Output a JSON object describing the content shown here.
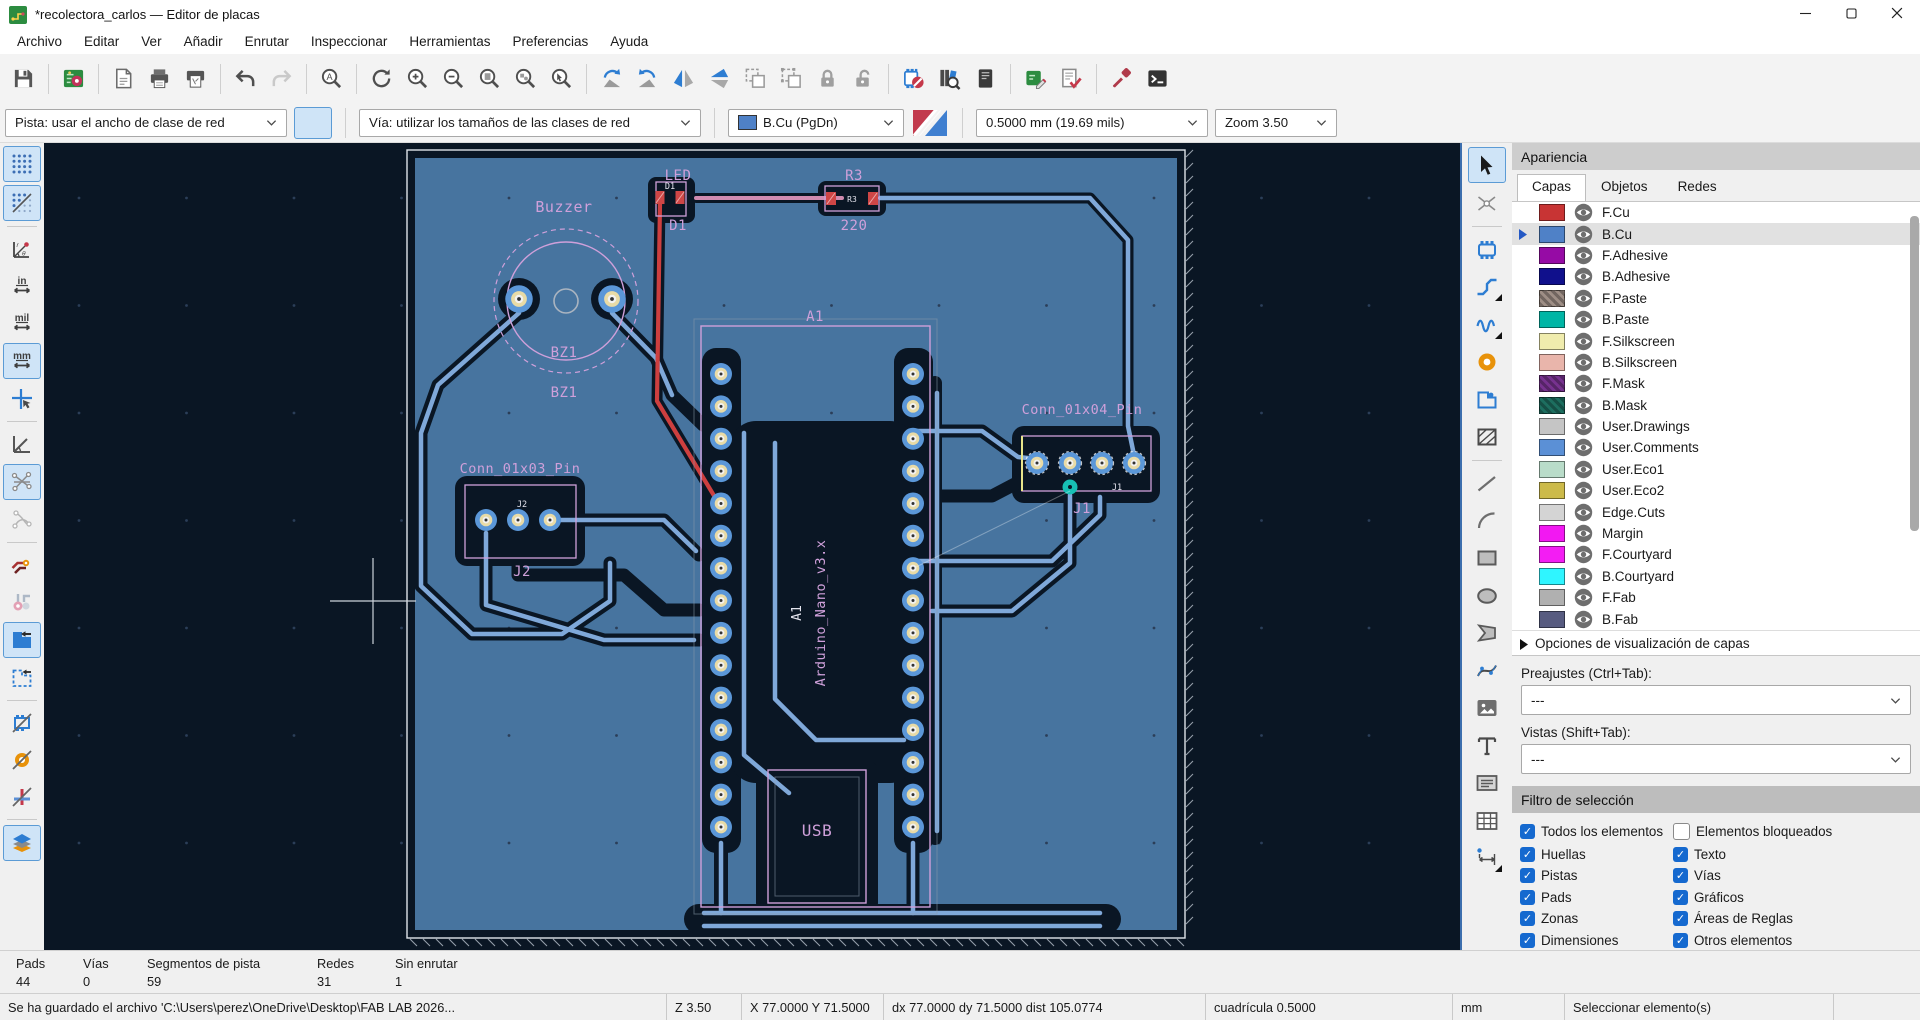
{
  "window": {
    "title": "*recolectora_carlos — Editor de placas"
  },
  "menu": {
    "items": [
      "Archivo",
      "Editar",
      "Ver",
      "Añadir",
      "Enrutar",
      "Inspeccionar",
      "Herramientas",
      "Preferencias",
      "Ayuda"
    ]
  },
  "toolbar": {
    "track_dropdown": "Pista: usar el ancho de clase de red",
    "via_dropdown": "Vía: utilizar los tamaños de las clases de red",
    "layer_dropdown": "B.Cu (PgDn)",
    "layer_color": "#4f81c7",
    "width_dropdown": "0.5000 mm (19.69 mils)",
    "zoom_dropdown": "Zoom 3.50"
  },
  "appearance": {
    "title": "Apariencia",
    "tabs": [
      "Capas",
      "Objetos",
      "Redes"
    ],
    "layers": [
      {
        "name": "F.Cu",
        "color": "#c83434"
      },
      {
        "name": "B.Cu",
        "color": "#4f81c7",
        "selected": true
      },
      {
        "name": "F.Adhesive",
        "color": "#960ba5"
      },
      {
        "name": "B.Adhesive",
        "color": "#10108c"
      },
      {
        "name": "F.Paste",
        "color": "#9e8e85",
        "checker": true
      },
      {
        "name": "B.Paste",
        "color": "#00b5a5"
      },
      {
        "name": "F.Silkscreen",
        "color": "#f0ecad"
      },
      {
        "name": "B.Silkscreen",
        "color": "#e9b5ab"
      },
      {
        "name": "F.Mask",
        "color": "#77328f",
        "checker": true
      },
      {
        "name": "B.Mask",
        "color": "#1d6e5f",
        "checker": true
      },
      {
        "name": "User.Drawings",
        "color": "#c5c5c5"
      },
      {
        "name": "User.Comments",
        "color": "#5b90d6"
      },
      {
        "name": "User.Eco1",
        "color": "#b9dcc9"
      },
      {
        "name": "User.Eco2",
        "color": "#ccba49"
      },
      {
        "name": "Edge.Cuts",
        "color": "#d4d4d4"
      },
      {
        "name": "Margin",
        "color": "#f218f2"
      },
      {
        "name": "F.Courtyard",
        "color": "#f31df3"
      },
      {
        "name": "B.Courtyard",
        "color": "#2ff5ff"
      },
      {
        "name": "F.Fab",
        "color": "#b0b0b0"
      },
      {
        "name": "B.Fab",
        "color": "#575b80"
      }
    ],
    "options_link": "Opciones de visualización de capas",
    "presets_label": "Preajustes (Ctrl+Tab):",
    "presets_value": "---",
    "views_label": "Vistas (Shift+Tab):",
    "views_value": "---"
  },
  "filter": {
    "title": "Filtro de selección",
    "items": [
      {
        "label": "Todos los elementos",
        "checked": true
      },
      {
        "label": "Elementos bloqueados",
        "checked": false
      },
      {
        "label": "Huellas",
        "checked": true
      },
      {
        "label": "Texto",
        "checked": true
      },
      {
        "label": "Pistas",
        "checked": true
      },
      {
        "label": "Vías",
        "checked": true
      },
      {
        "label": "Pads",
        "checked": true
      },
      {
        "label": "Gráficos",
        "checked": true
      },
      {
        "label": "Zonas",
        "checked": true
      },
      {
        "label": "Áreas de Reglas",
        "checked": true
      },
      {
        "label": "Dimensiones",
        "checked": true
      },
      {
        "label": "Otros elementos",
        "checked": true
      }
    ]
  },
  "status": {
    "counts": [
      {
        "label": "Pads",
        "value": "44"
      },
      {
        "label": "Vías",
        "value": "0"
      },
      {
        "label": "Segmentos de pista",
        "value": "59"
      },
      {
        "label": "Redes",
        "value": "31"
      },
      {
        "label": "Sin enrutar",
        "value": "1"
      }
    ],
    "message": "Se ha guardado el archivo 'C:\\Users\\perez\\OneDrive\\Desktop\\FAB LAB 2026...",
    "zoom": "Z 3.50",
    "position": "X 77.0000 Y 71.5000",
    "delta": "dx 77.0000  dy 71.5000  dist 105.0774",
    "grid": "cuadrícula 0.5000",
    "units": "mm",
    "action": "Seleccionar elemento(s)"
  },
  "canvas": {
    "background": "#0a1624",
    "zone_color": "#47749f",
    "track_color": "#7fa8d9",
    "silk_color": "#cfa0da",
    "fcu_color": "#cd3f3f",
    "via_color": "#17c0b4",
    "labels": {
      "buzzer": "Buzzer",
      "bz1": "BZ1",
      "led": "LED",
      "d1": "D1",
      "r3": "R3",
      "r220": "220",
      "a1": "A1",
      "nano": "Arduino_Nano_v3.x",
      "usb": "USB",
      "j2_conn": "Conn_01x03_Pin",
      "j2": "J2",
      "j1_conn": "Conn_01x04_Pin",
      "j1": "J1"
    }
  }
}
